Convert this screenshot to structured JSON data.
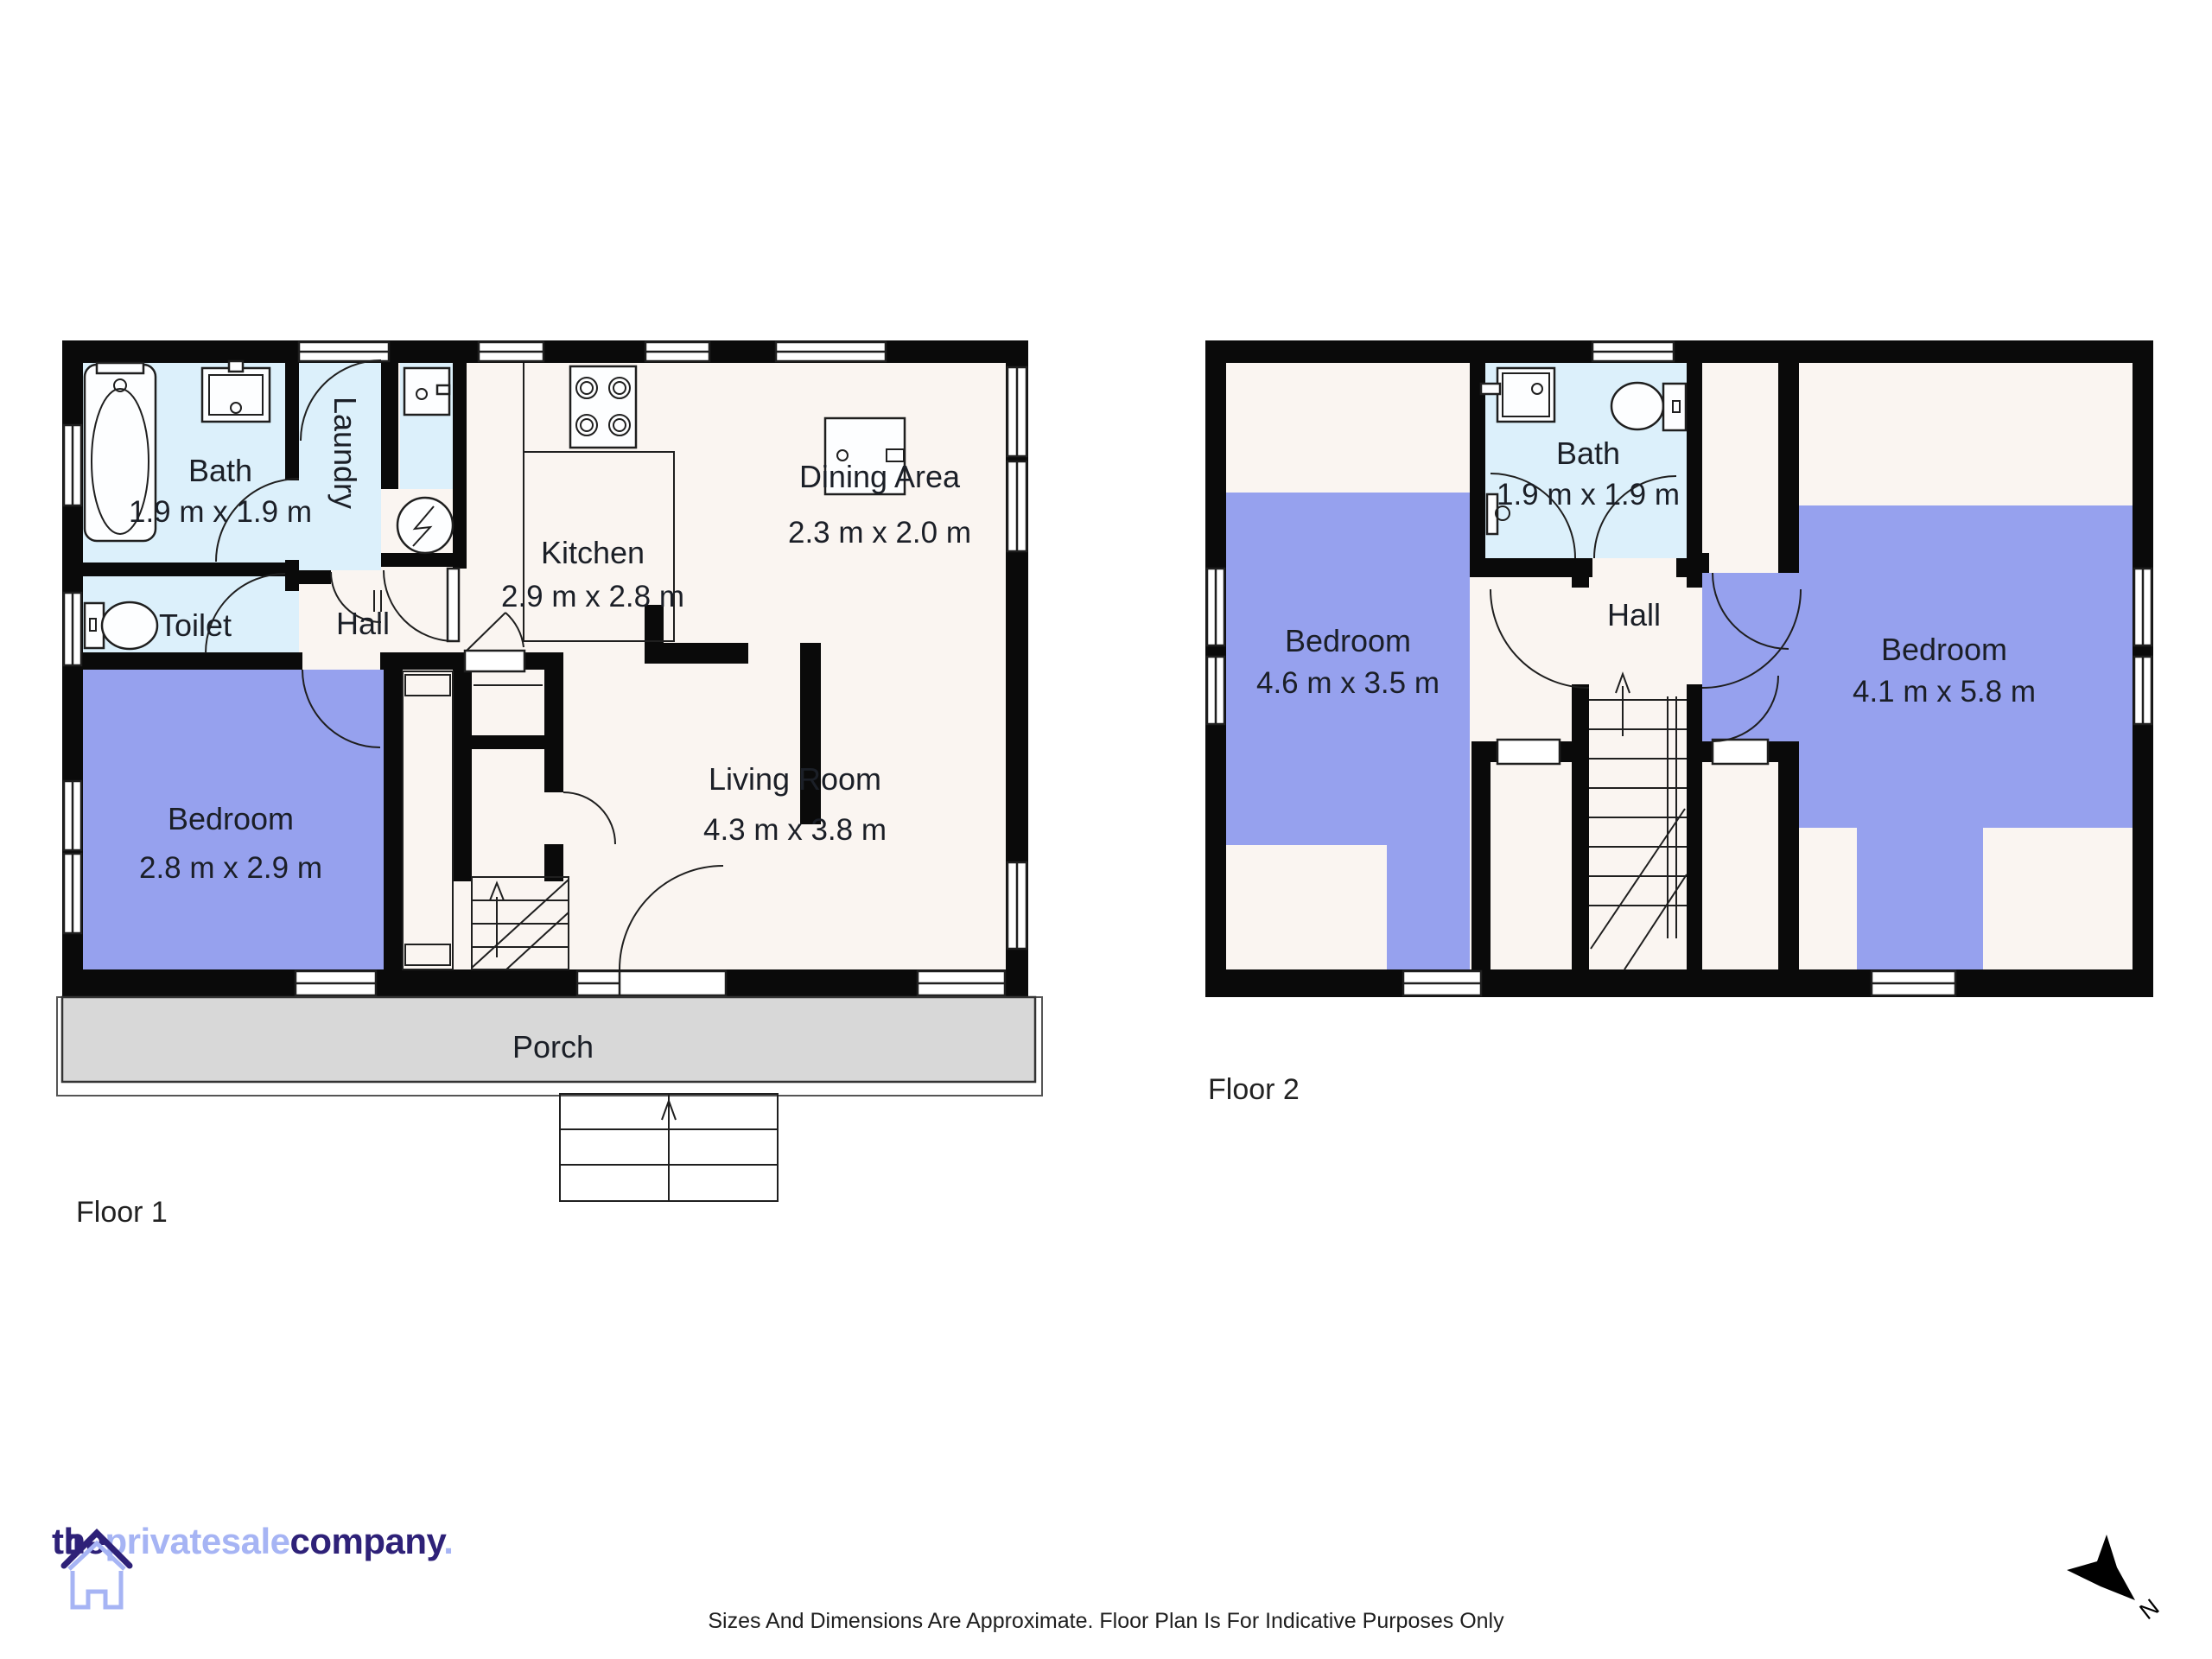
{
  "colors": {
    "wall": "#0a0a0a",
    "floor": "#faf5f1",
    "wet": "#dcf0fb",
    "bedroom": "#96a1ee",
    "porch": "#d8d8d8",
    "line": "#1f1f1f",
    "text": "#1b1f27",
    "logo_dark": "#2e2178",
    "logo_light": "#a6b4f4"
  },
  "floor1": {
    "label": "Floor 1",
    "rooms": {
      "bath": {
        "name": "Bath",
        "dims": "1.9 m x 1.9 m"
      },
      "laundry": {
        "name": "Laundry"
      },
      "toilet": {
        "name": "Toilet"
      },
      "hall": {
        "name": "Hall"
      },
      "kitchen": {
        "name": "Kitchen",
        "dims": "2.9 m x 2.8 m"
      },
      "dining": {
        "name": "Dining Area",
        "dims": "2.3 m x 2.0 m"
      },
      "living": {
        "name": "Living Room",
        "dims": "4.3 m x 3.8 m"
      },
      "bedroom": {
        "name": "Bedroom",
        "dims": "2.8 m x 2.9 m"
      },
      "porch": {
        "name": "Porch"
      }
    }
  },
  "floor2": {
    "label": "Floor 2",
    "rooms": {
      "bath": {
        "name": "Bath",
        "dims": "1.9 m x 1.9 m"
      },
      "hall": {
        "name": "Hall"
      },
      "bedroom_left": {
        "name": "Bedroom",
        "dims": "4.6 m x 3.5 m"
      },
      "bedroom_right": {
        "name": "Bedroom",
        "dims": "4.1 m x 5.8 m"
      }
    }
  },
  "compass": {
    "north_label": "N"
  },
  "footer": {
    "logo": {
      "part1": "the",
      "part2": "privatesale",
      "part3": "company",
      "part4": "."
    },
    "disclaimer": "Sizes And Dimensions Are Approximate. Floor Plan Is For Indicative Purposes Only"
  },
  "icons": [
    "bathtub-icon",
    "sink-icon",
    "toilet-icon",
    "washer-icon",
    "stove-icon",
    "fridge-icon",
    "shower-icon",
    "stairs-icon",
    "steps-icon",
    "compass-north-icon",
    "logo-house-icon"
  ]
}
